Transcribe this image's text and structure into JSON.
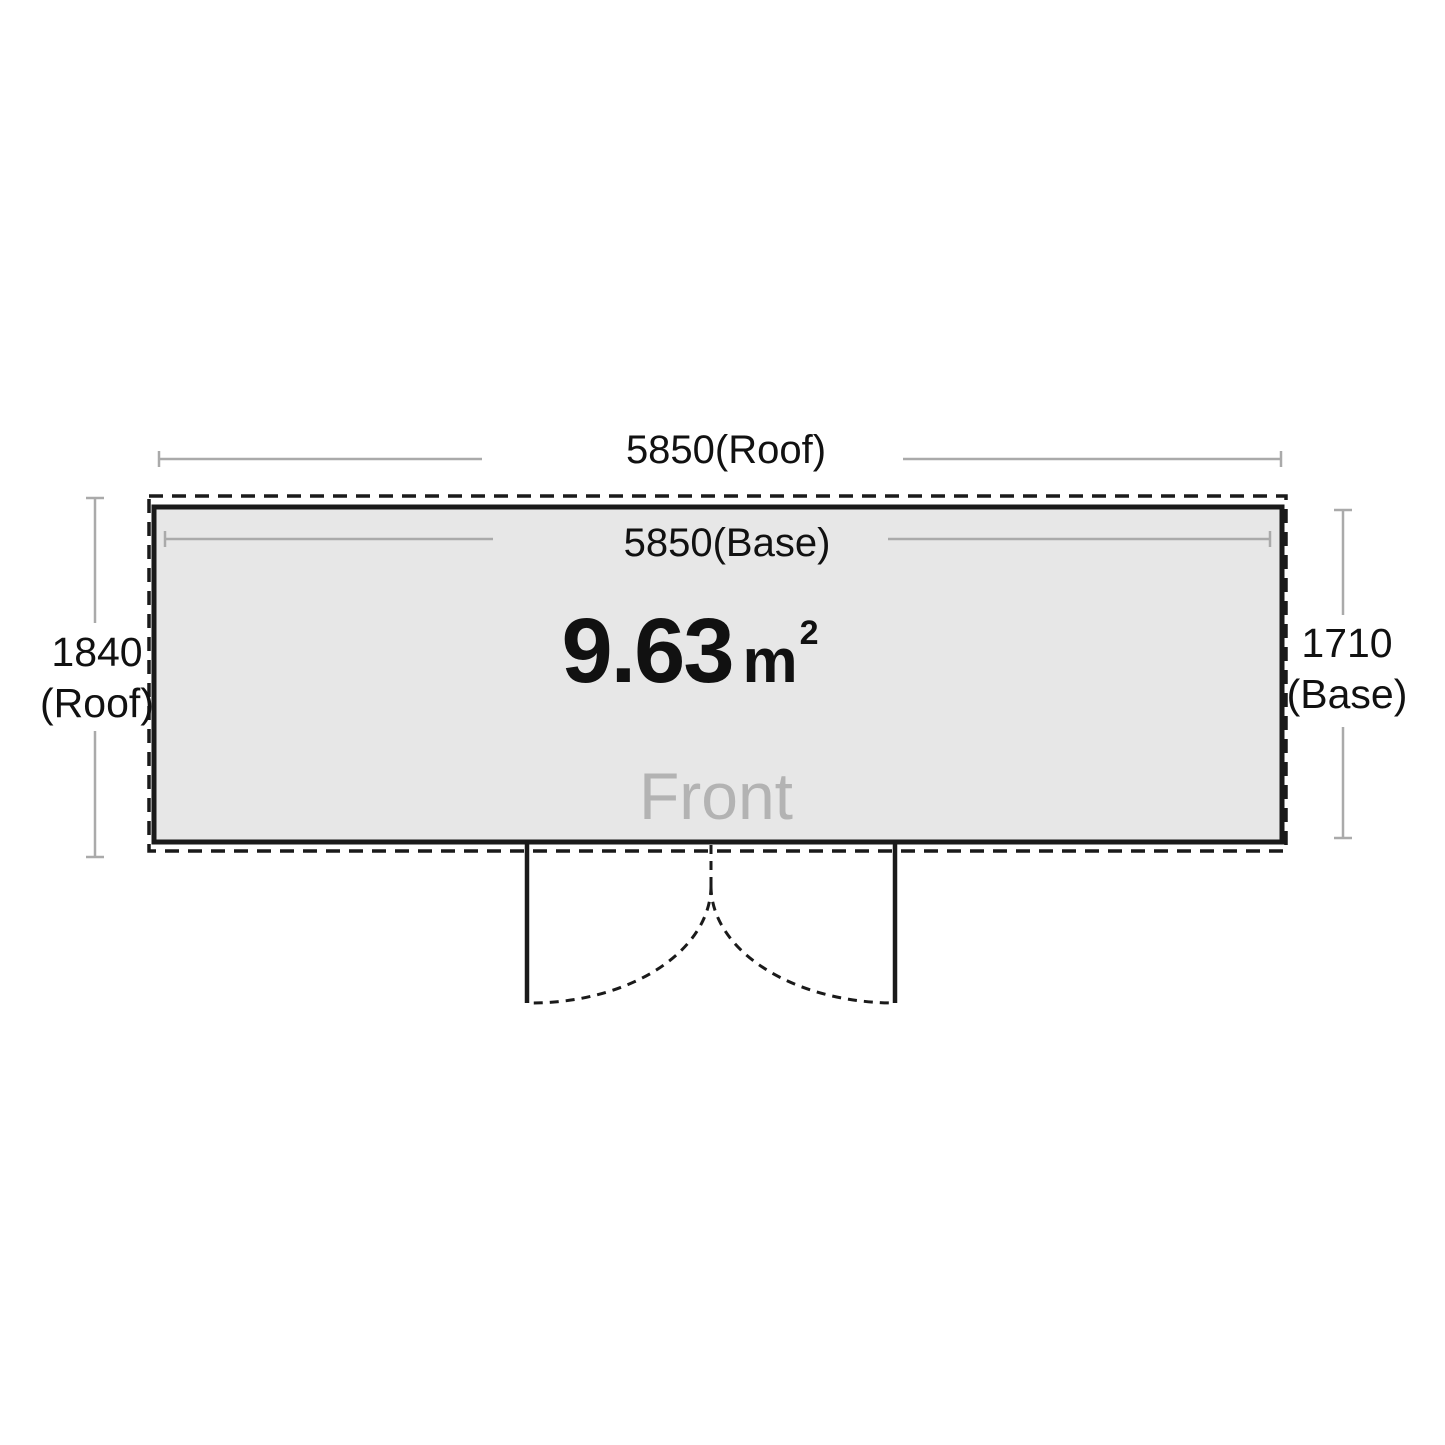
{
  "floorplan": {
    "dimensions": {
      "roof_width": "5850(Roof)",
      "base_width": "5850(Base)",
      "roof_depth_value": "1840",
      "roof_depth_unit": "(Roof)",
      "base_depth_value": "1710",
      "base_depth_unit": "(Base)"
    },
    "area": {
      "value": "9.63",
      "unit": "m",
      "exponent": "2"
    },
    "front_label": "Front",
    "colors": {
      "floor_fill": "#e7e7e7",
      "outline": "#1a1a1a",
      "dimension_line": "#aaaaaa",
      "front_text": "#b3b3b3"
    }
  }
}
